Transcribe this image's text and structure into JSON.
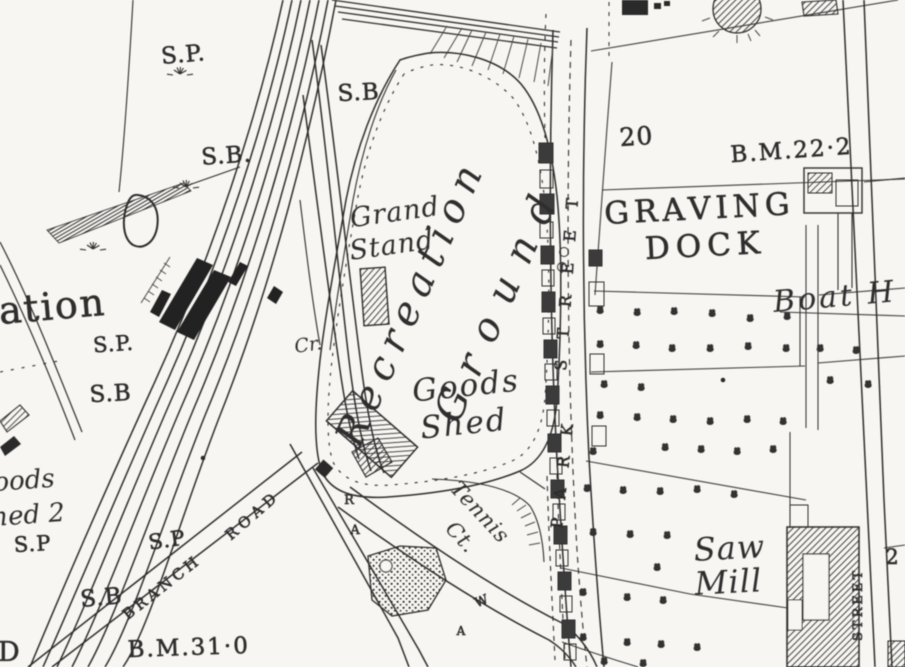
{
  "map": {
    "ink": "#2d2d2d",
    "paper": "#f7f6f2",
    "labels": [
      {
        "id": "sp-1",
        "t": "S.P.",
        "x": 184,
        "y": 62,
        "s": 23,
        "r": -5,
        "sp": 1,
        "hv": 1
      },
      {
        "id": "sb-1",
        "t": "S.B.",
        "x": 227,
        "y": 163,
        "s": 23,
        "r": -4,
        "sp": 1,
        "hv": 1
      },
      {
        "id": "sb-2",
        "t": "S.B",
        "x": 359,
        "y": 100,
        "s": 23,
        "r": -3,
        "sp": 1,
        "hv": 1
      },
      {
        "id": "station-name-fragment",
        "t": "ation",
        "x": 0,
        "y": 324,
        "s": 38,
        "r": -5,
        "sp": 2,
        "hv": 1,
        "a": "s"
      },
      {
        "id": "sp-2",
        "t": "S.P.",
        "x": 114,
        "y": 351,
        "s": 21,
        "r": -4,
        "sp": 1,
        "hv": 1
      },
      {
        "id": "sb-3",
        "t": "S.B",
        "x": 111,
        "y": 401,
        "s": 23,
        "r": -3,
        "sp": 1,
        "hv": 1
      },
      {
        "id": "goods-shed2-line1",
        "t": "oods",
        "x": -6,
        "y": 491,
        "s": 26,
        "r": -4,
        "sp": 0,
        "i": 1,
        "a": "s"
      },
      {
        "id": "goods-shed2-line2",
        "t": "hed 2",
        "x": -8,
        "y": 526,
        "s": 26,
        "r": -4,
        "sp": 0,
        "i": 1,
        "a": "s"
      },
      {
        "id": "sp-3",
        "t": "S.P",
        "x": 33,
        "y": 551,
        "s": 21,
        "r": -3,
        "sp": 1,
        "hv": 1
      },
      {
        "id": "sp-4",
        "t": "S.P",
        "x": 168,
        "y": 547,
        "s": 21,
        "r": -8,
        "sp": 1,
        "hv": 1
      },
      {
        "id": "sb-4",
        "t": "S.B",
        "x": 102,
        "y": 605,
        "s": 23,
        "r": -5,
        "sp": 1,
        "hv": 1
      },
      {
        "id": "bm-31",
        "t": "B.M.31·0",
        "x": 189,
        "y": 655,
        "s": 23,
        "r": -2,
        "sp": 2,
        "hv": 1
      },
      {
        "id": "letter-fragment-d",
        "t": "D",
        "x": -2,
        "y": 661,
        "s": 27,
        "r": 0,
        "sp": 0,
        "hv": 1,
        "a": "s"
      },
      {
        "id": "branch-road-word1",
        "t": "BRANCH",
        "x": 165,
        "y": 591,
        "s": 15,
        "r": -38,
        "sp": 4,
        "hv": 1
      },
      {
        "id": "branch-road-word2",
        "t": "ROAD",
        "x": 256,
        "y": 519,
        "s": 15,
        "r": -41,
        "sp": 5,
        "hv": 1
      },
      {
        "id": "grand-stand-line1",
        "t": "Grand",
        "x": 396,
        "y": 221,
        "s": 27,
        "r": -8,
        "sp": 1,
        "i": 1
      },
      {
        "id": "grand-stand-line2",
        "t": "Stand",
        "x": 393,
        "y": 254,
        "s": 27,
        "r": -8,
        "sp": 1,
        "i": 1
      },
      {
        "id": "recreation-ground-line1",
        "t": "Recreation",
        "x": 423,
        "y": 307,
        "s": 40,
        "r": -66,
        "sp": 9,
        "i": 1
      },
      {
        "id": "recreation-ground-line2",
        "t": "Ground",
        "x": 511,
        "y": 306,
        "s": 40,
        "r": -66,
        "sp": 18,
        "i": 1
      },
      {
        "id": "goods-shed-line1",
        "t": "Goods",
        "x": 467,
        "y": 396,
        "s": 31,
        "r": -6,
        "sp": 2,
        "i": 1
      },
      {
        "id": "goods-shed-line2",
        "t": "Shed",
        "x": 465,
        "y": 434,
        "s": 31,
        "r": -6,
        "sp": 2,
        "i": 1
      },
      {
        "id": "tennis-ct-line1",
        "t": "Tennis",
        "x": 475,
        "y": 517,
        "s": 21,
        "r": 47,
        "sp": 1,
        "i": 1
      },
      {
        "id": "tennis-ct-line2",
        "t": "Ct.",
        "x": 456,
        "y": 542,
        "s": 21,
        "r": 47,
        "sp": 1,
        "i": 1
      },
      {
        "id": "park-street-word1",
        "t": "PARK",
        "x": 562,
        "y": 529,
        "s": 16,
        "r": -84,
        "sp": 20,
        "hv": 1,
        "a": "s"
      },
      {
        "id": "park-street-word2",
        "t": "STREET",
        "x": 566,
        "y": 371,
        "s": 16,
        "r": -86,
        "sp": 21,
        "hv": 1,
        "a": "s"
      },
      {
        "id": "graving-dock-line1",
        "t": "GRAVING",
        "x": 700,
        "y": 219,
        "s": 31,
        "r": -3,
        "sp": 5,
        "hv": 1
      },
      {
        "id": "graving-dock-line2",
        "t": "DOCK",
        "x": 706,
        "y": 256,
        "s": 31,
        "r": -3,
        "sp": 6,
        "hv": 1
      },
      {
        "id": "plot-number-20",
        "t": "20",
        "x": 637,
        "y": 145,
        "s": 25,
        "r": -4,
        "sp": 1,
        "hv": 1
      },
      {
        "id": "bm-22",
        "t": "B.M.22·2",
        "x": 792,
        "y": 158,
        "s": 23,
        "r": -4,
        "sp": 2,
        "hv": 1
      },
      {
        "id": "boat-house-fragment",
        "t": "Boat H",
        "x": 774,
        "y": 312,
        "s": 30,
        "r": -5,
        "sp": 3,
        "i": 1,
        "a": "s"
      },
      {
        "id": "saw-mill-line1",
        "t": "Saw",
        "x": 730,
        "y": 559,
        "s": 32,
        "r": -3,
        "sp": 1,
        "i": 1
      },
      {
        "id": "saw-mill-line2",
        "t": "Mill",
        "x": 729,
        "y": 593,
        "s": 32,
        "r": -3,
        "sp": 1,
        "i": 1
      },
      {
        "id": "street-east",
        "t": "STREET",
        "x": 862,
        "y": 641,
        "s": 13,
        "r": -90,
        "sp": 3,
        "hv": 1,
        "a": "s"
      },
      {
        "id": "plot-number-2",
        "t": "2",
        "x": 892,
        "y": 564,
        "s": 21,
        "r": 0,
        "sp": 0,
        "hv": 1
      },
      {
        "id": "crane-abbrev",
        "t": "Cr.",
        "x": 309,
        "y": 351,
        "s": 19,
        "r": -8,
        "sp": 0,
        "i": 1
      },
      {
        "id": "road-letter-r",
        "t": "R",
        "x": 349,
        "y": 504,
        "s": 13,
        "r": 0,
        "sp": 0,
        "hv": 1
      },
      {
        "id": "road-letter-a1",
        "t": "A",
        "x": 355,
        "y": 534,
        "s": 13,
        "r": 0,
        "sp": 0,
        "hv": 1
      },
      {
        "id": "road-letter-w",
        "t": "W",
        "x": 483,
        "y": 605,
        "s": 13,
        "r": -22,
        "sp": 0,
        "hv": 1
      },
      {
        "id": "road-letter-a2",
        "t": "A",
        "x": 461,
        "y": 635,
        "s": 12,
        "r": 0,
        "sp": 0,
        "hv": 1
      }
    ],
    "trees": [
      [
        600,
        312
      ],
      [
        637,
        314
      ],
      [
        674,
        313
      ],
      [
        712,
        315
      ],
      [
        750,
        320
      ],
      [
        787,
        318
      ],
      [
        600,
        346
      ],
      [
        636,
        347
      ],
      [
        672,
        350
      ],
      [
        710,
        350
      ],
      [
        748,
        348
      ],
      [
        786,
        350
      ],
      [
        820,
        350
      ],
      [
        856,
        352
      ],
      [
        604,
        386
      ],
      [
        641,
        389
      ],
      [
        830,
        382
      ],
      [
        868,
        386
      ],
      [
        600,
        417
      ],
      [
        637,
        419
      ],
      [
        673,
        421
      ],
      [
        710,
        423
      ],
      [
        747,
        421
      ],
      [
        783,
        423
      ],
      [
        593,
        453
      ],
      [
        665,
        449
      ],
      [
        701,
        451
      ],
      [
        737,
        453
      ],
      [
        773,
        451
      ],
      [
        587,
        490
      ],
      [
        623,
        492
      ],
      [
        660,
        493
      ],
      [
        697,
        491
      ],
      [
        734,
        496
      ],
      [
        593,
        534
      ],
      [
        630,
        536
      ],
      [
        667,
        537
      ],
      [
        657,
        569
      ],
      [
        583,
        594
      ],
      [
        627,
        599
      ],
      [
        663,
        602
      ],
      [
        583,
        639
      ],
      [
        627,
        644
      ],
      [
        661,
        646
      ],
      [
        697,
        649
      ],
      [
        604,
        663
      ],
      [
        643,
        665
      ]
    ],
    "tufts": [
      [
        180,
        74
      ],
      [
        186,
        187
      ],
      [
        93,
        249
      ]
    ],
    "dots": [
      [
        203,
        458
      ],
      [
        723,
        380
      ]
    ]
  }
}
